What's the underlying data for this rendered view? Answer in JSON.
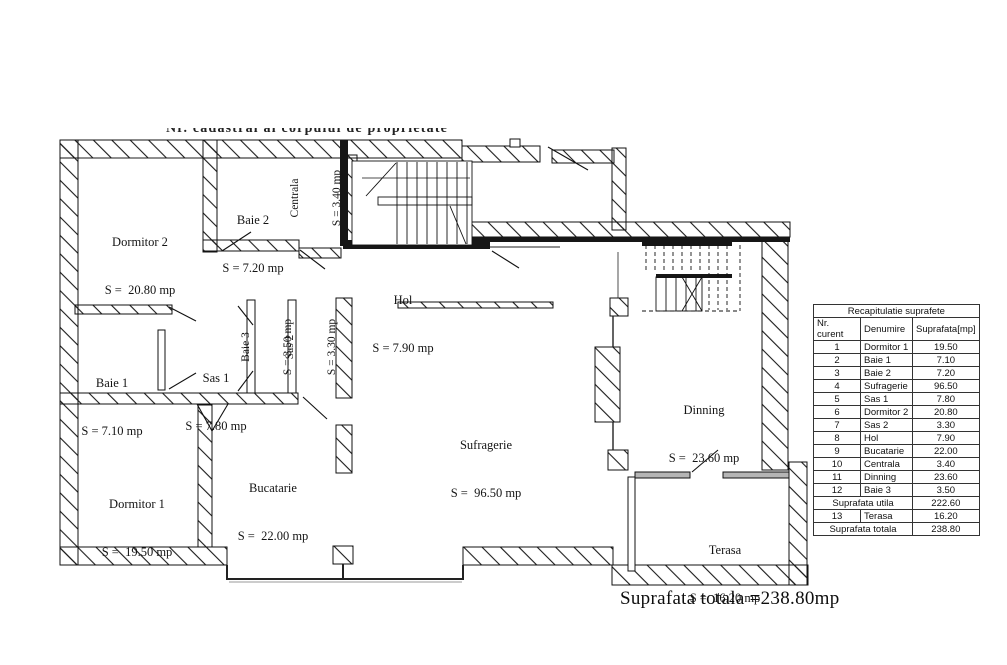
{
  "captions": {
    "top_clipped": "Nr. cadastral al corpului de proprietate",
    "total": "Suprafata totala =238.80mp"
  },
  "rooms": {
    "dormitor2": {
      "name": "Dormitor 2",
      "area": "S =  20.80 mp"
    },
    "baie2": {
      "name": "Baie 2",
      "area": "S = 7.20 mp"
    },
    "centrala": {
      "name": "Centrala",
      "area": "S = 3.40 mp"
    },
    "hol": {
      "name": "Hol",
      "area": "S = 7.90 mp"
    },
    "baie1": {
      "name": "Baie 1",
      "area": "S = 7.10 mp"
    },
    "sas1": {
      "name": "Sas 1",
      "area": "S = 7.80 mp"
    },
    "baie3": {
      "name": "Baie 3",
      "area": "S = 3.50 mp"
    },
    "sas2": {
      "name": "Sas 2",
      "area": "S = 3.30 mp"
    },
    "dormitor1": {
      "name": "Dormitor 1",
      "area": "S =  19.50 mp"
    },
    "bucatarie": {
      "name": "Bucatarie",
      "area": "S =  22.00 mp"
    },
    "sufragerie": {
      "name": "Sufragerie",
      "area": "S =  96.50 mp"
    },
    "dinning": {
      "name": "Dinning",
      "area": "S =  23.60 mp"
    },
    "terasa": {
      "name": "Terasa",
      "area": "S =  16.20 mp"
    }
  },
  "table": {
    "title": "Recapitulatie suprafete",
    "headers": [
      "Nr. curent",
      "Denumire",
      "Suprafata[mp]"
    ],
    "rows": [
      [
        "1",
        "Dormitor 1",
        "19.50"
      ],
      [
        "2",
        "Baie 1",
        "7.10"
      ],
      [
        "3",
        "Baie 2",
        "7.20"
      ],
      [
        "4",
        "Sufragerie",
        "96.50"
      ],
      [
        "5",
        "Sas 1",
        "7.80"
      ],
      [
        "6",
        "Dormitor 2",
        "20.80"
      ],
      [
        "7",
        "Sas 2",
        "3.30"
      ],
      [
        "8",
        "Hol",
        "7.90"
      ],
      [
        "9",
        "Bucatarie",
        "22.00"
      ],
      [
        "10",
        "Centrala",
        "3.40"
      ],
      [
        "11",
        "Dinning",
        "23.60"
      ],
      [
        "12",
        "Baie 3",
        "3.50"
      ]
    ],
    "utila": {
      "label": "Suprafata utila",
      "value": "222.60"
    },
    "terasa_row": {
      "nr": "13",
      "name": "Terasa",
      "value": "16.20"
    },
    "totala": {
      "label": "Suprafata totala",
      "value": "238.80"
    }
  }
}
